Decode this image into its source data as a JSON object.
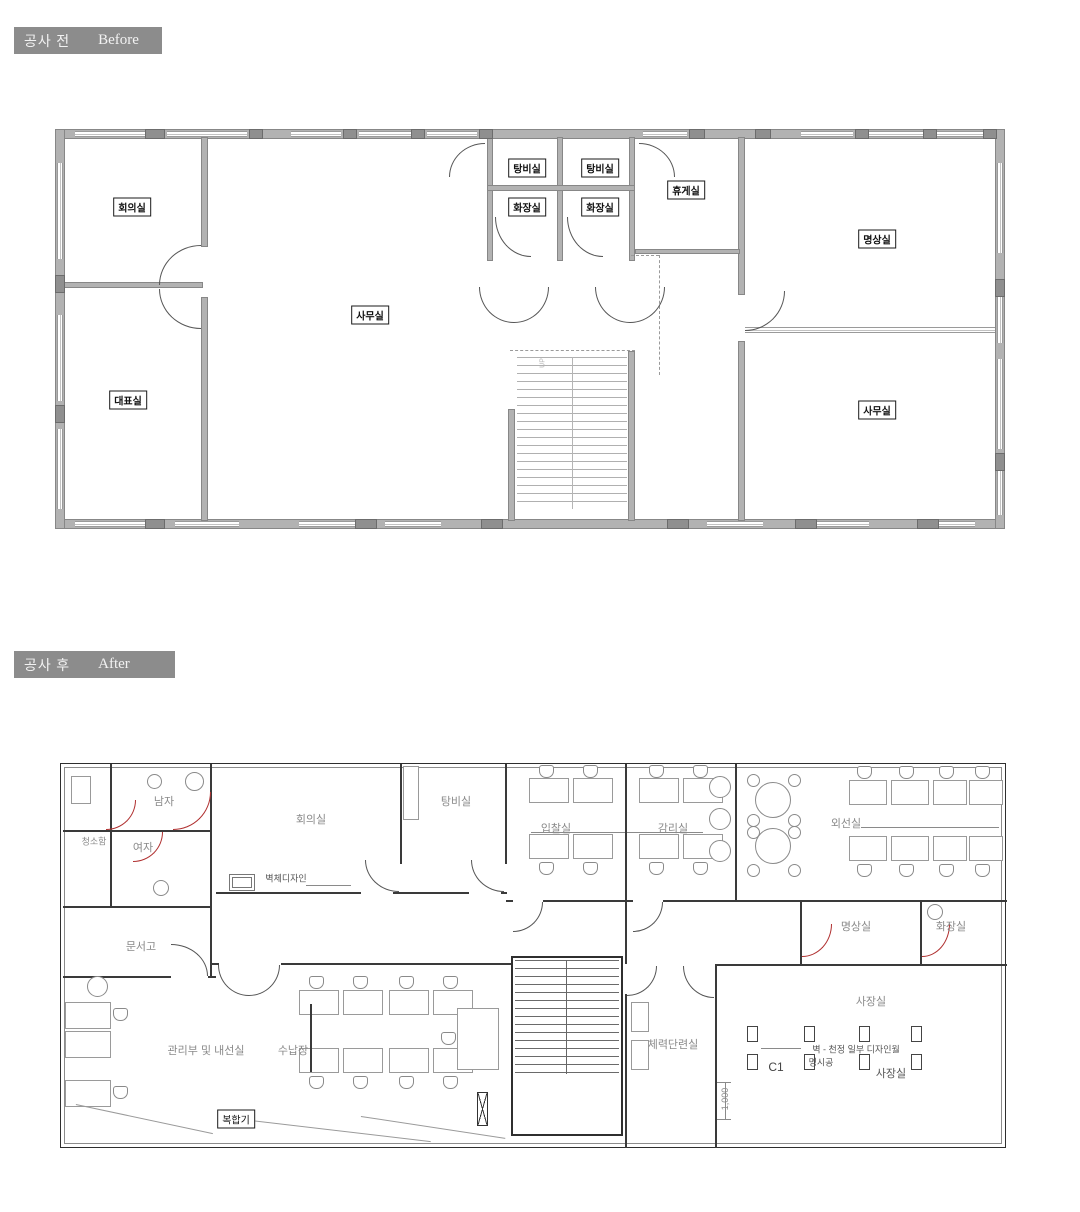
{
  "headers": {
    "before": {
      "korean": "공사 전",
      "english": "Before"
    },
    "after": {
      "korean": "공사 후",
      "english": "After"
    }
  },
  "before_plan": {
    "rooms": {
      "meeting": "회의실",
      "ceo": "대표실",
      "office_center": "사무실",
      "pantry_1": "탕비실",
      "pantry_2": "탕비실",
      "toilet_1": "화장실",
      "toilet_2": "화장실",
      "lounge": "휴게실",
      "meditation": "명상실",
      "office_right": "사무실",
      "stairs_up": "UP"
    }
  },
  "after_plan": {
    "rooms": {
      "men": "남자",
      "cleaning": "청소함",
      "women": "여자",
      "archive": "문서고",
      "meeting": "회의실",
      "pantry": "탕비실",
      "bidding": "입찰실",
      "supervision": "감리실",
      "outside_line": "외선실",
      "meditation": "명상실",
      "toilet": "화장실",
      "president": "사장실",
      "fitness": "체력단련실",
      "admin": "관리부 및 내선실",
      "cabinet": "수납장",
      "copier": "복합기"
    },
    "annotations": {
      "wall_design": "벽체디자인",
      "c1": "C1",
      "design_wall_note": "벽 - 천정 일부 디자인월",
      "spec_note": "명시공",
      "president_small": "사장실",
      "dimension": "1,000"
    }
  },
  "colors": {
    "header_bar": "#8c8c8c",
    "before_wall": "#b2b2b2",
    "after_wall": "#3a3a3a",
    "door_red": "#b03030"
  }
}
